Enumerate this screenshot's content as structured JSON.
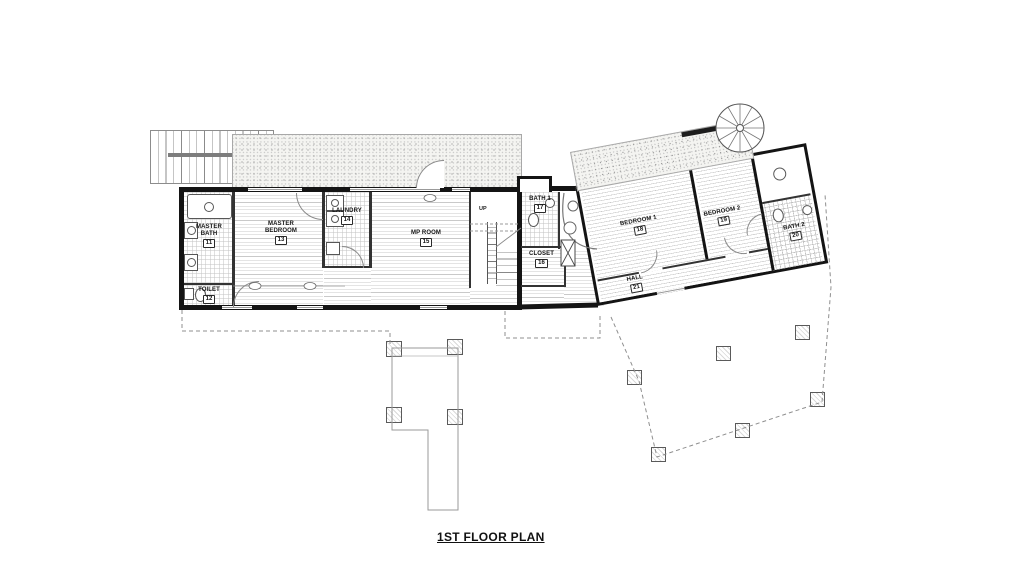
{
  "title": "1ST FLOOR PLAN",
  "rooms": {
    "master_bath": {
      "label": "MASTER BATH",
      "number": "11"
    },
    "toilet": {
      "label": "TOILET",
      "number": "12"
    },
    "master_bedroom": {
      "label": "MASTER BEDROOM",
      "number": "13"
    },
    "laundry": {
      "label": "LAUNDRY",
      "number": "14"
    },
    "mp_room": {
      "label": "MP ROOM",
      "number": "15"
    },
    "closet": {
      "label": "CLOSET",
      "number": "16"
    },
    "bath_1": {
      "label": "BATH 1",
      "number": "17"
    },
    "bedroom_1": {
      "label": "BEDROOM 1",
      "number": "18"
    },
    "bedroom_2": {
      "label": "BEDROOM 2",
      "number": "19"
    },
    "bath_2": {
      "label": "BATH 2",
      "number": "20"
    },
    "hall": {
      "label": "HALL",
      "number": "21"
    }
  },
  "stairs": {
    "up_label": "UP"
  }
}
